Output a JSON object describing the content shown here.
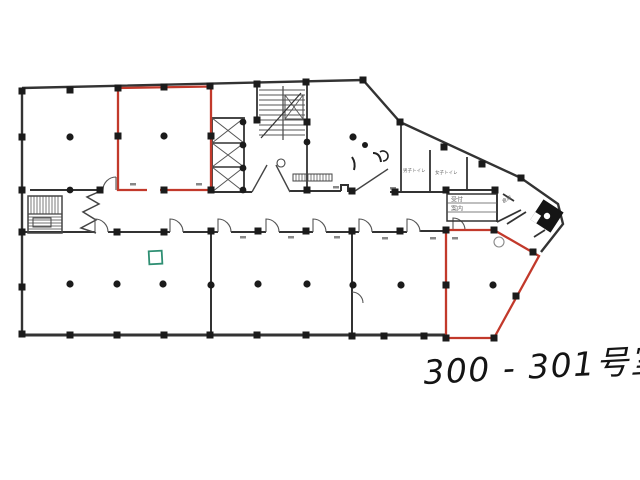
{
  "annotation": {
    "handwritten_room_label": "300 - 301号室"
  },
  "plan": {
    "highlight_color": "#c2392b",
    "wall_color": "#333333",
    "marker_green": "#2f8f73",
    "elevator_fill": "#151515",
    "room_labels": {
      "mens_toilet": "男子トイレ",
      "womens_toilet": "女子トイレ",
      "sign_line1": "受付",
      "sign_line2": "案内",
      "storage": "倉庫"
    }
  }
}
